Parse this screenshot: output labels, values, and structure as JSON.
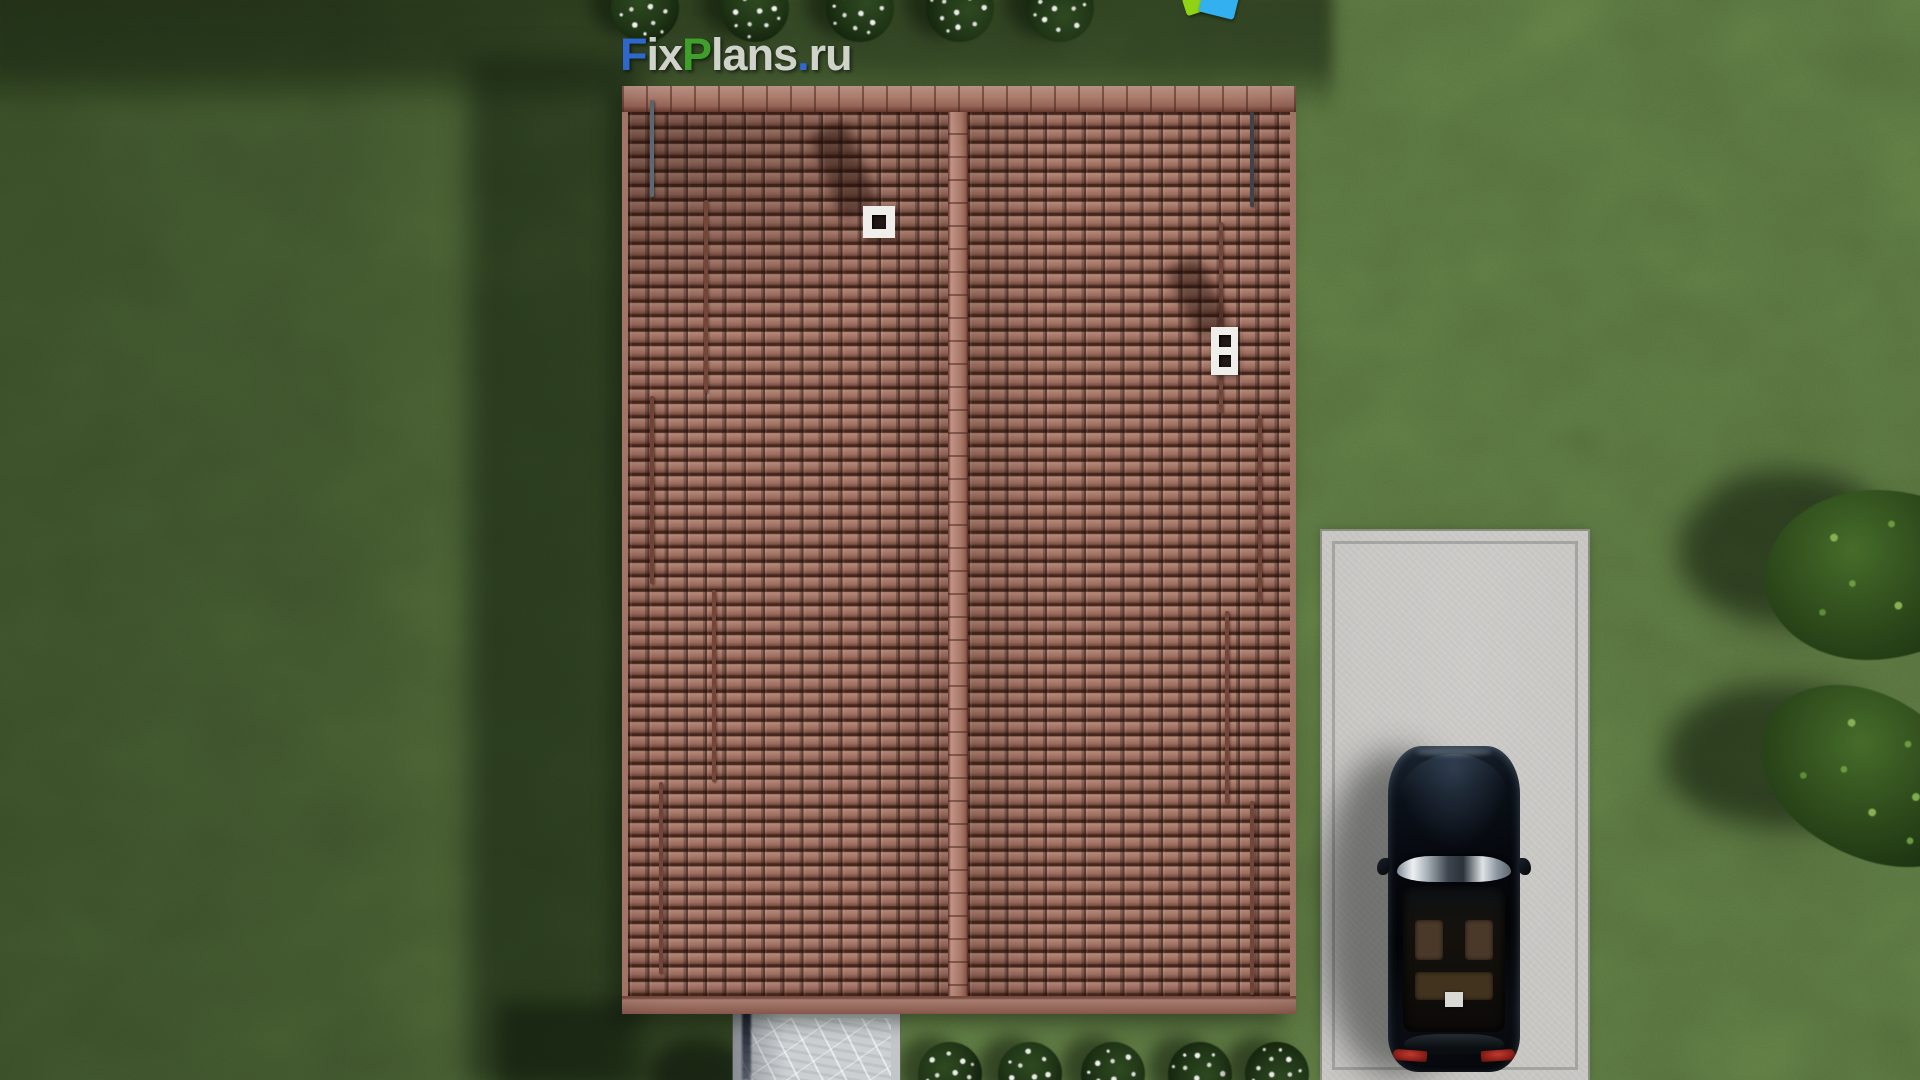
{
  "watermark": {
    "text": "FixPlans.ru",
    "letters": [
      {
        "t": "F",
        "c": "#2f6bd6"
      },
      {
        "t": "ix",
        "c": "#d8dbd3"
      },
      {
        "t": "P",
        "c": "#3fa42c"
      },
      {
        "t": "lans",
        "c": "#d8dbd3"
      },
      {
        "t": ".",
        "c": "#2f6bd6"
      },
      {
        "t": "ru",
        "c": "#d8dbd3"
      }
    ]
  },
  "scene": {
    "description": "Top-down 3D render of a house with a gabled red-tile roof on a lawn, concrete driveway with a black car, stone walkway, white-flower bushes and trees",
    "colors": {
      "grass": "#5a7540",
      "grass_shadow": "#24371c",
      "roof_tile": "#a0705f",
      "roof_ridge": "#b4857a",
      "driveway": "#c9c8c5",
      "walkway": "#ccd0d3",
      "car_body": "#0a0d12",
      "car_taillight": "#b03028",
      "chimney": "#efeeea",
      "flowers": "#e8ebe4",
      "tree_foliage": "#2f4c1c"
    }
  },
  "roof": {
    "rods": [
      {
        "x": 652,
        "y1": 100,
        "y2": 197,
        "color": "#5f6d78"
      },
      {
        "x": 706,
        "y1": 200,
        "y2": 393,
        "color": "#74463a"
      },
      {
        "x": 652,
        "y1": 396,
        "y2": 584,
        "color": "#74463a"
      },
      {
        "x": 714,
        "y1": 590,
        "y2": 782,
        "color": "#74463a"
      },
      {
        "x": 661,
        "y1": 782,
        "y2": 974,
        "color": "#74463a"
      },
      {
        "x": 1252,
        "y1": 112,
        "y2": 207,
        "color": "#41454b"
      },
      {
        "x": 1221,
        "y1": 222,
        "y2": 413,
        "color": "#74463a"
      },
      {
        "x": 1260,
        "y1": 415,
        "y2": 603,
        "color": "#74463a"
      },
      {
        "x": 1227,
        "y1": 611,
        "y2": 803,
        "color": "#74463a"
      },
      {
        "x": 1252,
        "y1": 801,
        "y2": 995,
        "color": "#74463a"
      }
    ],
    "chimneys": [
      {
        "x": 863,
        "y": 206,
        "w": 32,
        "h": 32,
        "holes": 1,
        "shadow": {
          "x": 824,
          "y": 124,
          "w": 40,
          "h": 92,
          "rot": -21
        }
      },
      {
        "x": 1211,
        "y": 327,
        "w": 27,
        "h": 48,
        "holes": 2,
        "shadow": {
          "x": 1180,
          "y": 258,
          "w": 36,
          "h": 78,
          "rot": -26
        }
      }
    ]
  },
  "bushes": {
    "top_x": [
      645,
      755,
      860,
      960,
      1060
    ],
    "bottom_x": [
      950,
      1030,
      1113,
      1200,
      1277
    ]
  },
  "trees": [
    {
      "cx": 1880,
      "cy": 575,
      "rx": 115,
      "ry": 85,
      "shadow": {
        "cx": 1786,
        "cy": 548,
        "rx": 108,
        "ry": 78
      }
    },
    {
      "cx": 1872,
      "cy": 778,
      "rx": 118,
      "ry": 80,
      "shadow": {
        "cx": 1775,
        "cy": 756,
        "rx": 112,
        "ry": 72
      }
    }
  ],
  "playground": {
    "pieces": [
      {
        "color": "#8fd315",
        "x": 1184,
        "y": -5,
        "w": 24,
        "h": 18,
        "rot": -18
      },
      {
        "color": "#33b0f0",
        "x": 1201,
        "y": -10,
        "w": 36,
        "h": 26,
        "rot": 14
      }
    ]
  }
}
